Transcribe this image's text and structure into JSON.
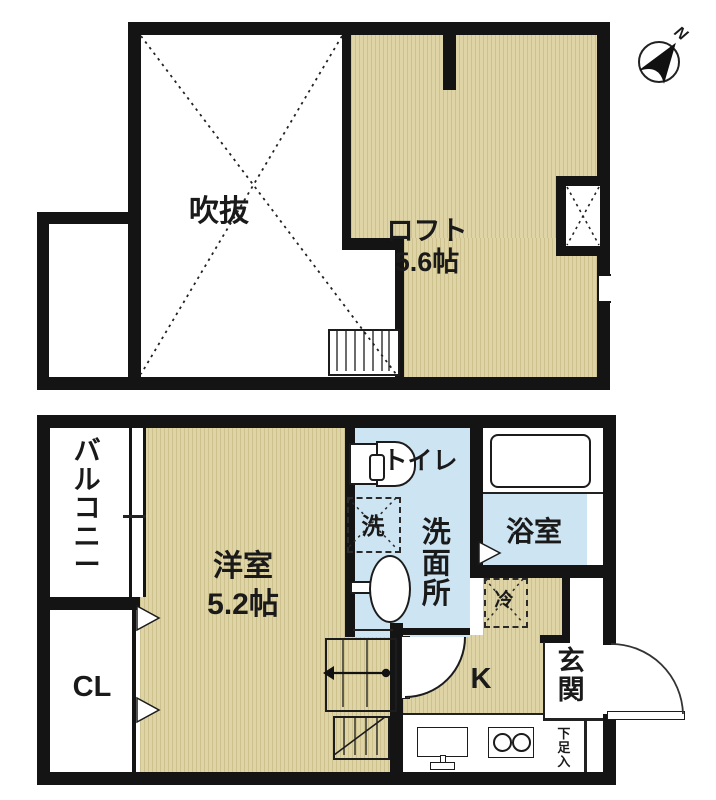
{
  "title": "apartment-floor-plan",
  "compass": {
    "north_label": "N"
  },
  "colors": {
    "wall": "#141414",
    "wood_floor": "#ded4a6",
    "wood_stripe": "#cdc28d",
    "water_blue": "#cde4f2",
    "background": "#ffffff",
    "line": "#1a1a1a"
  },
  "upper_floor": {
    "void": {
      "label": "吹抜"
    },
    "loft": {
      "label": "ロフト",
      "size": "5.6帖"
    }
  },
  "lower_floor": {
    "balcony": {
      "label": "バルコニー"
    },
    "closet": {
      "label": "CL"
    },
    "western_room": {
      "label": "洋室",
      "size": "5.2帖"
    },
    "toilet": {
      "label": "トイレ"
    },
    "laundry": {
      "label": "洗"
    },
    "washroom": {
      "label": "洗面所"
    },
    "bathroom": {
      "label": "浴室"
    },
    "refrigerator": {
      "label": "冷"
    },
    "kitchen": {
      "label": "K"
    },
    "entrance": {
      "label": "玄関"
    },
    "shoe_box": {
      "label": "下足入"
    }
  }
}
